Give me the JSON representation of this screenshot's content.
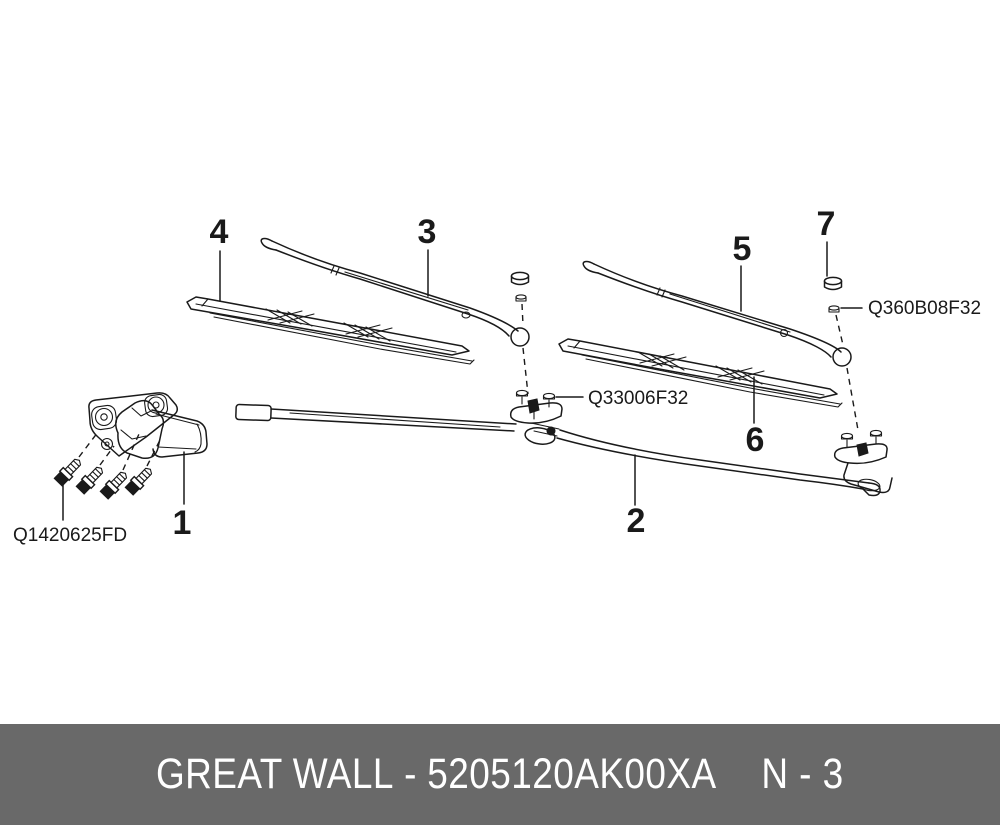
{
  "diagram": {
    "line_color": "#1a1a1a",
    "callouts": [
      {
        "label": "1"
      },
      {
        "label": "2"
      },
      {
        "label": "3"
      },
      {
        "label": "4"
      },
      {
        "label": "5"
      },
      {
        "label": "6"
      },
      {
        "label": "7"
      }
    ],
    "part_codes": [
      {
        "label": "Q1420625FD"
      },
      {
        "label": "Q33006F32"
      },
      {
        "label": "Q360B08F32"
      }
    ]
  },
  "footer": {
    "brand": "GREAT WALL",
    "separator": "-",
    "part_number": "5205120AK00XA",
    "page_ref": "N - 3",
    "background": "#696969",
    "text_color": "#ffffff"
  }
}
